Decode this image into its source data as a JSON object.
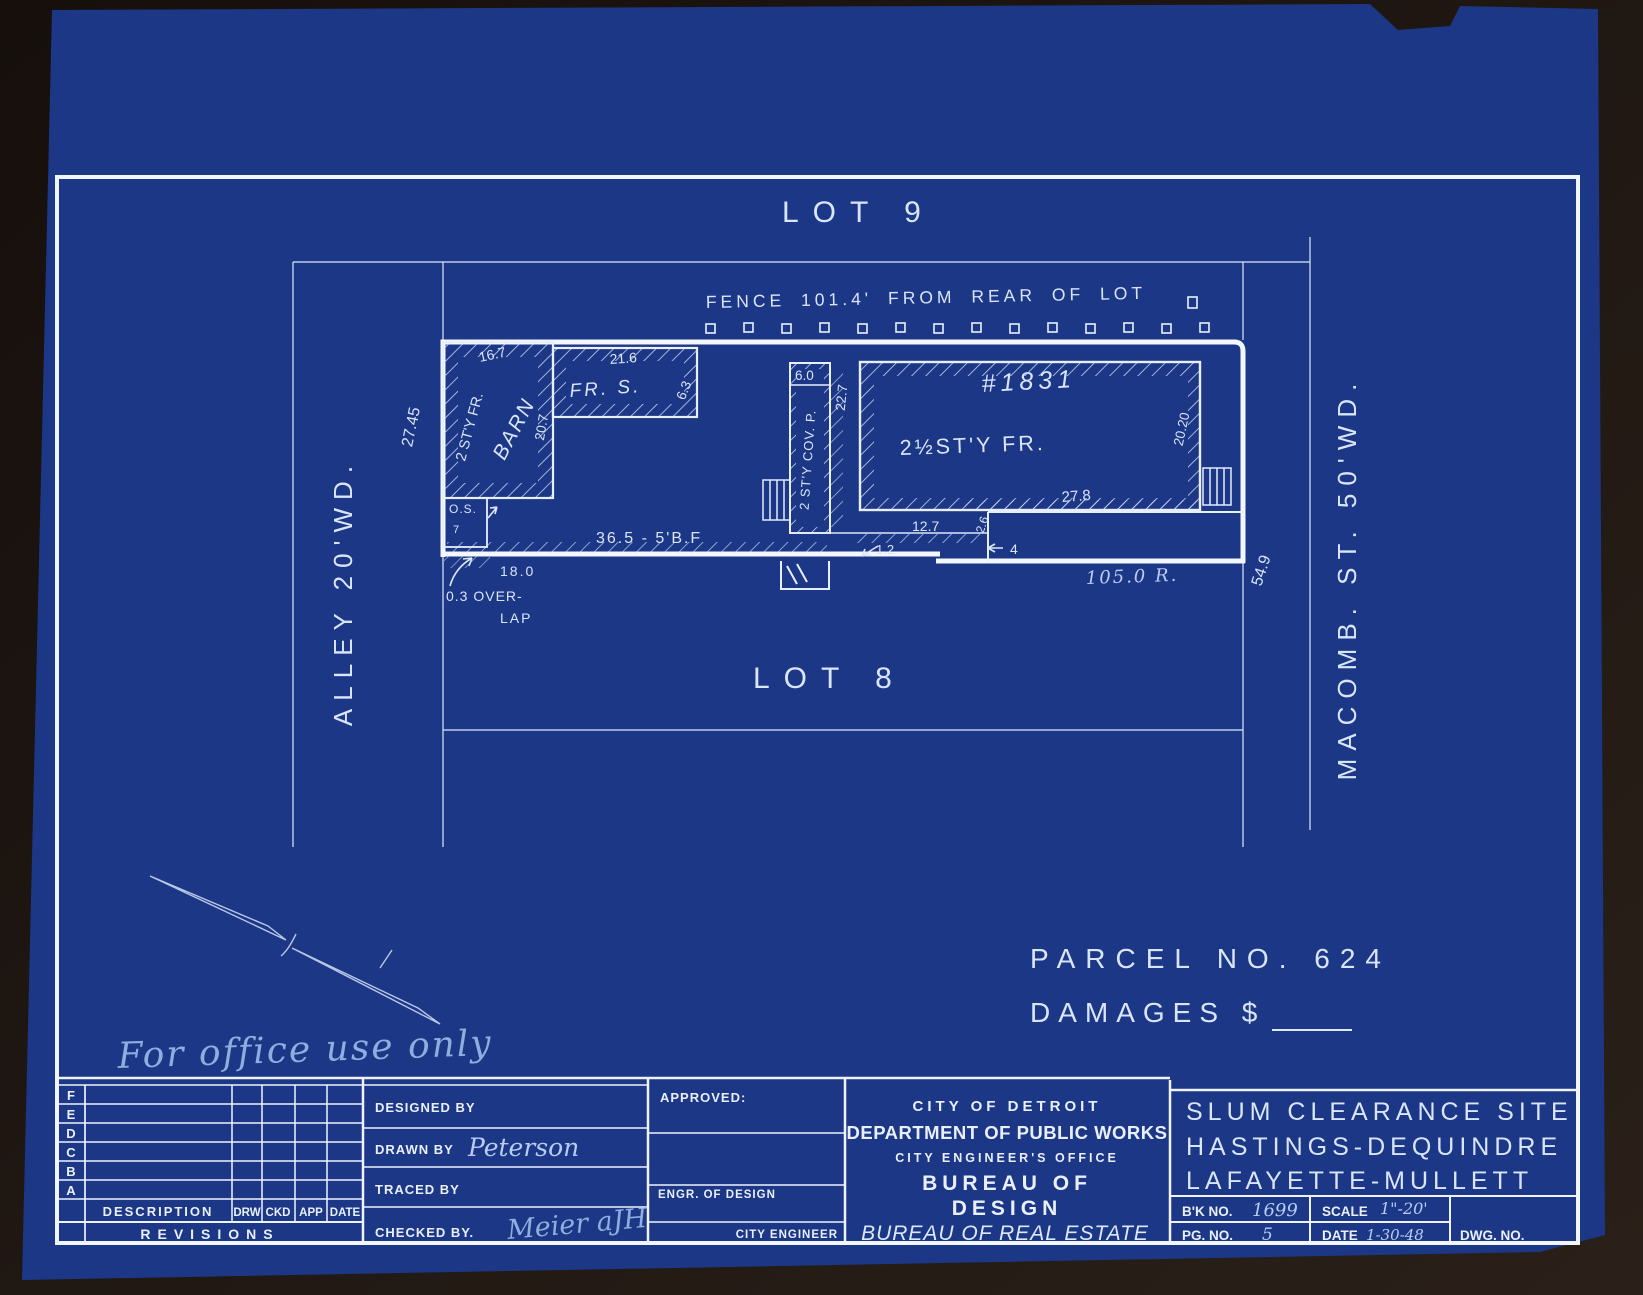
{
  "colors": {
    "background": "#1d1612",
    "paper": "#1c3786",
    "line_bright": "#f3f7ff",
    "line_thin": "#c9daf4",
    "hand_ink": "#b9cdf4"
  },
  "plan": {
    "lot9": "LOT 9",
    "lot8": "LOT 8",
    "fence_note": "FENCE 101.4' FROM REAR OF LOT",
    "alley": "ALLEY  20'WD.",
    "macomb": "MACOMB.  ST.  50'WD.",
    "dim_west": "27.45",
    "dim_east": "54.9",
    "dim_rear": "105.0 R.",
    "barn": {
      "story": "2 ST'Y FR.",
      "name": "BARN",
      "dim_top": "16.7",
      "dim_right": "20.7"
    },
    "frame_shed": {
      "name": "FR. S.",
      "dim_top": "21.6",
      "dim_right": "6.3"
    },
    "porch": {
      "name": "2 ST'Y COV. P.",
      "dim_top": "6.0",
      "dim_right": "22.7"
    },
    "house": {
      "number": "#1831",
      "story": "2½ST'Y FR.",
      "dim_right": "20.20",
      "dim_step": "27.8",
      "dim_b1": "12.7",
      "dim_b2": "2.6",
      "dim_jog": "1.2",
      "dim_notch": "4"
    },
    "os_box": {
      "name": "O.S.",
      "d1": "7"
    },
    "board_fence": "36.5 - 5'B.F",
    "dim_18": "18.0",
    "overlap_line1": "0.3 OVER-",
    "overlap_line2": "LAP"
  },
  "notes": {
    "parcel": "PARCEL NO. 624",
    "damages": "DAMAGES $",
    "office": "For office use only"
  },
  "titleblock": {
    "revision_letters": [
      "F",
      "E",
      "D",
      "C",
      "B",
      "A"
    ],
    "description": "DESCRIPTION",
    "drw": "DRW",
    "ckd": "CKD",
    "app": "APP",
    "date_col": "DATE",
    "revisions": "REVISIONS",
    "designed_by": "DESIGNED BY",
    "drawn_by": "DRAWN BY",
    "drawn_by_value": "Peterson",
    "traced_by": "TRACED BY",
    "checked_by": "CHECKED BY.",
    "checked_by_value": "Meier aJH",
    "approved": "APPROVED:",
    "engr_of_design": "ENGR. OF DESIGN",
    "city_engineer": "CITY ENGINEER",
    "org1": "CITY OF DETROIT",
    "org2": "DEPARTMENT OF PUBLIC WORKS",
    "org3": "CITY ENGINEER'S OFFICE",
    "org4": "BUREAU OF",
    "org5": "DESIGN",
    "org6": "BUREAU OF REAL ESTATE",
    "site1": "SLUM CLEARANCE SITE",
    "site2": "HASTINGS-DEQUINDRE",
    "site3": "LAFAYETTE-MULLETT",
    "bk_no_label": "B'K NO.",
    "bk_no_value": "1699",
    "scale_label": "SCALE",
    "scale_value": "1\"-20'",
    "pg_no_label": "PG. NO.",
    "pg_no_value": "5",
    "date_label": "DATE",
    "date_value": "1-30-48",
    "dwg_no_label": "DWG. NO."
  }
}
